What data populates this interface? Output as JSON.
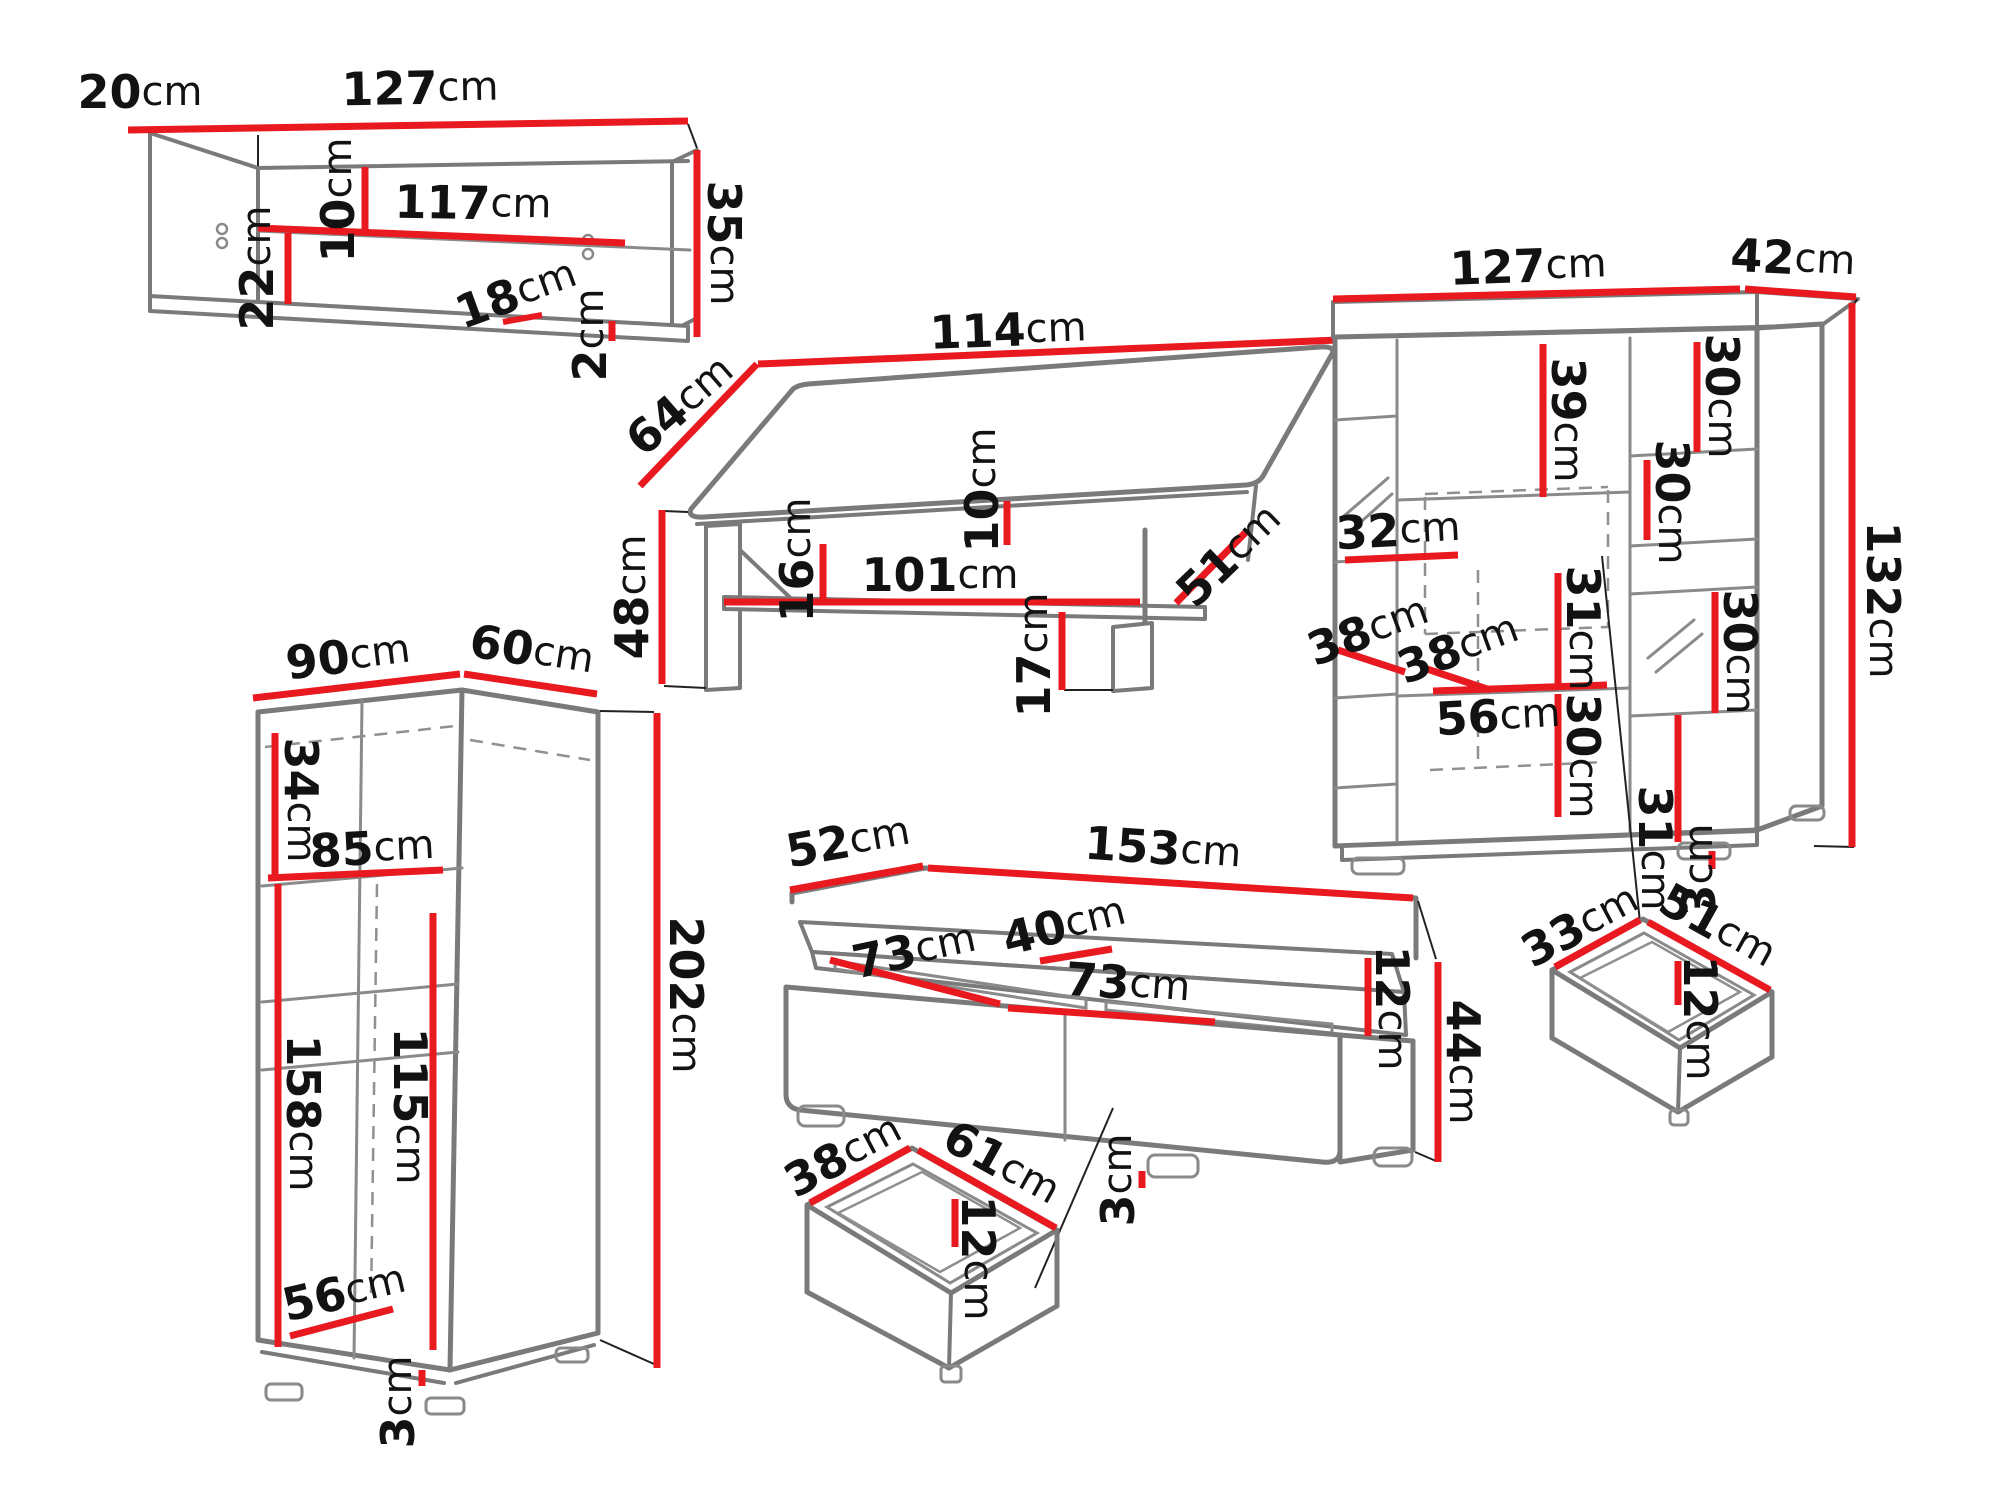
{
  "colors": {
    "accent_red": "#e8191f",
    "line_gray": "#7a7a7a",
    "ink": "#121212",
    "background": "#ffffff"
  },
  "furniture": {
    "wall_shelf": {
      "depth": {
        "v": "20",
        "u": "cm"
      },
      "width": {
        "v": "127",
        "u": "cm"
      },
      "height": {
        "v": "35",
        "u": "cm"
      },
      "inner_width": {
        "v": "117",
        "u": "cm"
      },
      "top_clearance": {
        "v": "10",
        "u": "cm"
      },
      "bottom_clearance": {
        "v": "22",
        "u": "cm"
      },
      "shelf_depth": {
        "v": "18",
        "u": "cm"
      },
      "board_thickness": {
        "v": "2",
        "u": "cm"
      }
    },
    "coffee_table": {
      "width": {
        "v": "114",
        "u": "cm"
      },
      "depth": {
        "v": "64",
        "u": "cm"
      },
      "height": {
        "v": "48",
        "u": "cm"
      },
      "shelf_clearance": {
        "v": "16",
        "u": "cm"
      },
      "shelf_width": {
        "v": "101",
        "u": "cm"
      },
      "top_thickness": {
        "v": "10",
        "u": "cm"
      },
      "shelf_depth": {
        "v": "51",
        "u": "cm"
      },
      "leg_height": {
        "v": "17",
        "u": "cm"
      }
    },
    "bookcase": {
      "width": {
        "v": "127",
        "u": "cm"
      },
      "depth": {
        "v": "42",
        "u": "cm"
      },
      "height": {
        "v": "132",
        "u": "cm"
      },
      "mid_upper": {
        "v": "39",
        "u": "cm"
      },
      "right_top": {
        "v": "30",
        "u": "cm"
      },
      "right_upper": {
        "v": "30",
        "u": "cm"
      },
      "left_shelf_width": {
        "v": "32",
        "u": "cm"
      },
      "shelf_depth_left": {
        "v": "38",
        "u": "cm"
      },
      "shelf_depth_mid": {
        "v": "38",
        "u": "cm"
      },
      "mid_mid": {
        "v": "31",
        "u": "cm"
      },
      "mid_width": {
        "v": "56",
        "u": "cm"
      },
      "mid_lower": {
        "v": "30",
        "u": "cm"
      },
      "right_mid": {
        "v": "30",
        "u": "cm"
      },
      "right_lower": {
        "v": "31",
        "u": "cm"
      },
      "foot_height": {
        "v": "3",
        "u": "cm"
      }
    },
    "wardrobe": {
      "width": {
        "v": "90",
        "u": "cm"
      },
      "depth": {
        "v": "60",
        "u": "cm"
      },
      "height": {
        "v": "202",
        "u": "cm"
      },
      "top_section": {
        "v": "34",
        "u": "cm"
      },
      "inner_width": {
        "v": "85",
        "u": "cm"
      },
      "left_inner_height": {
        "v": "158",
        "u": "cm"
      },
      "right_inner_height": {
        "v": "115",
        "u": "cm"
      },
      "bottom_depth": {
        "v": "56",
        "u": "cm"
      },
      "foot_height": {
        "v": "3",
        "u": "cm"
      }
    },
    "tv_stand": {
      "depth": {
        "v": "52",
        "u": "cm"
      },
      "width": {
        "v": "153",
        "u": "cm"
      },
      "shelf_depth": {
        "v": "40",
        "u": "cm"
      },
      "left_compartment": {
        "v": "73",
        "u": "cm"
      },
      "right_compartment": {
        "v": "73",
        "u": "cm"
      },
      "shelf_height": {
        "v": "12",
        "u": "cm"
      },
      "height": {
        "v": "44",
        "u": "cm"
      },
      "foot_height": {
        "v": "3",
        "u": "cm"
      }
    },
    "drawer_left": {
      "depth": {
        "v": "38",
        "u": "cm"
      },
      "width": {
        "v": "61",
        "u": "cm"
      },
      "height": {
        "v": "12",
        "u": "cm"
      }
    },
    "drawer_right": {
      "depth": {
        "v": "33",
        "u": "cm"
      },
      "width": {
        "v": "51",
        "u": "cm"
      },
      "height": {
        "v": "12",
        "u": "cm"
      }
    }
  }
}
